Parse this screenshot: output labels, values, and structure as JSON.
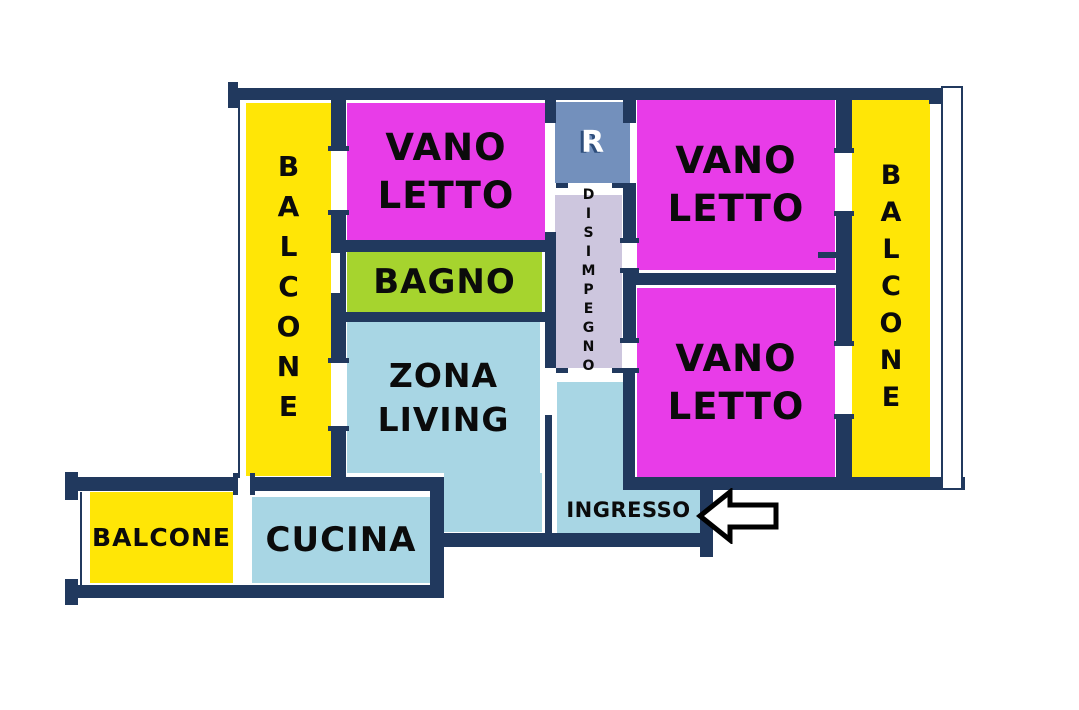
{
  "colors": {
    "background": "#FFFFFF",
    "wall": "#21395E",
    "bedroom_fill": "#E83CE8",
    "bathroom_fill": "#A6D42E",
    "living_fill": "#A8D6E4",
    "kitchen_fill": "#A8D6E4",
    "entrance_fill": "#A8D6E4",
    "balcony_fill": "#FFE606",
    "hallway_fill": "#CDC6DE",
    "riser_fill": "#7390BC",
    "label_color": "#0B0B0B",
    "riser_label_color": "#FFFFFF",
    "arrow_outline": "#000000",
    "arrow_fill": "#FFFFFF"
  },
  "rooms": {
    "balcony_left": {
      "label": "BALCONE"
    },
    "bedroom_top_left": {
      "label": "VANO\nLETTO"
    },
    "bathroom": {
      "label": "BAGNO"
    },
    "living_room": {
      "label": "ZONA\nLIVING"
    },
    "riser": {
      "label": "R"
    },
    "hallway": {
      "label": "DISIMPEGNO"
    },
    "bedroom_top_right": {
      "label": "VANO\nLETTO"
    },
    "bedroom_bottom_right": {
      "label": "VANO\nLETTO"
    },
    "balcony_right": {
      "label": "BALCONE"
    },
    "entrance": {
      "label": "INGRESSO"
    },
    "kitchen": {
      "label": "CUCINA"
    },
    "balcony_bottom_left": {
      "label": "BALCONE"
    }
  }
}
